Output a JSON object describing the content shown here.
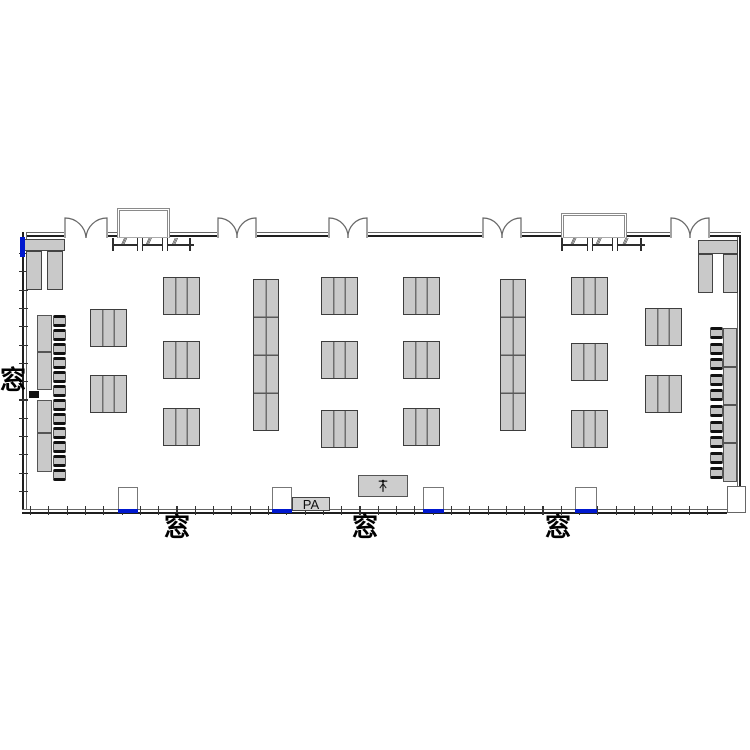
{
  "labels": {
    "window_left": "窓",
    "window_bottom_1": "窓",
    "window_bottom_2": "窓",
    "window_bottom_3": "窓",
    "pa": "PA",
    "rack_hatch": "///"
  },
  "colors": {
    "wall": "#1f1f1f",
    "furniture_fill": "#c9c9c9",
    "furniture_border": "#3d3d3d",
    "window_marker_blue": "#0018cf",
    "background": "#ffffff"
  },
  "icons": {
    "stage_icon": "mic-stand-icon"
  },
  "floorplan": {
    "walls": [
      {
        "dir": "h",
        "x": 22,
        "y": 232,
        "w": 42,
        "h": 5
      },
      {
        "dir": "h",
        "x": 108,
        "y": 232,
        "w": 109,
        "h": 5
      },
      {
        "dir": "h",
        "x": 257,
        "y": 232,
        "w": 71,
        "h": 5
      },
      {
        "dir": "h",
        "x": 368,
        "y": 232,
        "w": 114,
        "h": 5
      },
      {
        "dir": "h",
        "x": 522,
        "y": 232,
        "w": 148,
        "h": 5
      },
      {
        "dir": "h",
        "x": 710,
        "y": 232,
        "w": 31,
        "h": 5
      },
      {
        "dir": "v",
        "x": 22,
        "y": 232,
        "w": 5,
        "h": 281
      },
      {
        "dir": "v",
        "side": "right",
        "x": 737,
        "y": 237,
        "w": 4,
        "h": 249
      },
      {
        "dir": "h",
        "x": 22,
        "y": 509,
        "w": 705,
        "h": 5
      }
    ],
    "ticks": {
      "left": {
        "x": 19,
        "w": 9,
        "h": 1.2,
        "y0": 253,
        "y1": 506,
        "step": 18.3
      },
      "bottom": {
        "y": 506,
        "w": 1.2,
        "h": 9,
        "x0": 30,
        "x1": 723,
        "step": 18.3
      }
    },
    "doors": [
      {
        "x": 64,
        "y": 216,
        "w": 44,
        "h": 22
      },
      {
        "x": 217,
        "y": 216,
        "w": 40,
        "h": 22
      },
      {
        "x": 328,
        "y": 216,
        "w": 40,
        "h": 22
      },
      {
        "x": 482,
        "y": 216,
        "w": 40,
        "h": 22
      },
      {
        "x": 670,
        "y": 216,
        "w": 40,
        "h": 22
      }
    ],
    "alcoves": [
      {
        "x": 117,
        "y": 208,
        "w": 53,
        "h": 30
      },
      {
        "x": 561,
        "y": 213,
        "w": 66,
        "h": 25
      }
    ],
    "coat_racks": [
      {
        "x": 112,
        "y": 238,
        "w": 82,
        "h": 14
      },
      {
        "x": 561,
        "y": 238,
        "w": 84,
        "h": 14
      }
    ],
    "benches": [
      {
        "x": 24,
        "y": 239,
        "w": 41,
        "h": 12
      },
      {
        "x": 26,
        "y": 251,
        "w": 16,
        "h": 39
      },
      {
        "x": 47,
        "y": 251,
        "w": 16,
        "h": 39
      },
      {
        "x": 698,
        "y": 240,
        "w": 40,
        "h": 14
      },
      {
        "x": 698,
        "y": 254,
        "w": 15,
        "h": 39
      },
      {
        "x": 723,
        "y": 254,
        "w": 15,
        "h": 39
      }
    ],
    "tables_standard": [
      [
        90,
        309
      ],
      [
        90,
        375
      ],
      [
        163,
        277
      ],
      [
        163,
        341
      ],
      [
        163,
        408
      ],
      [
        321,
        277
      ],
      [
        321,
        341
      ],
      [
        321,
        410
      ],
      [
        403,
        277
      ],
      [
        403,
        341
      ],
      [
        403,
        408
      ],
      [
        571,
        277
      ],
      [
        571,
        343
      ],
      [
        571,
        410
      ],
      [
        645,
        308
      ],
      [
        645,
        375
      ]
    ],
    "table_standard_size": {
      "w": 37,
      "h": 38
    },
    "tables_long": [
      [
        253,
        279
      ],
      [
        500,
        279
      ]
    ],
    "table_long_size": {
      "w": 26,
      "h": 152
    },
    "counters": {
      "left": {
        "x": 37,
        "w": 15,
        "segments": [
          {
            "y": 315,
            "h": 37
          },
          {
            "y": 352,
            "h": 38
          },
          {
            "y": 400,
            "h": 33
          },
          {
            "y": 433,
            "h": 39
          }
        ]
      },
      "right": {
        "x": 723,
        "w": 14,
        "segments": [
          {
            "y": 328,
            "h": 39
          },
          {
            "y": 367,
            "h": 38
          },
          {
            "y": 405,
            "h": 38
          },
          {
            "y": 443,
            "h": 39
          }
        ]
      }
    },
    "black_marks": [
      {
        "x": 29,
        "y": 391,
        "w": 10,
        "h": 7
      }
    ],
    "chairs": {
      "left": {
        "x": 53,
        "w": 13,
        "h": 12,
        "y_start": 315,
        "step": 14,
        "count": 12
      },
      "right": {
        "x": 710,
        "w": 13,
        "h": 12,
        "y_start": 327,
        "step": 15.6,
        "count": 10
      }
    },
    "pillars": [
      {
        "x": 118,
        "w": 20
      },
      {
        "x": 272,
        "w": 20
      },
      {
        "x": 423,
        "w": 21
      },
      {
        "x": 575,
        "w": 22
      }
    ],
    "pillar_y": 487,
    "pillar_h": 23,
    "blue_markers": [
      {
        "x": 20,
        "y": 237,
        "w": 5,
        "h": 20
      }
    ],
    "corner_boxes": [
      {
        "x": 727,
        "y": 486,
        "w": 19,
        "h": 27
      }
    ],
    "stage": {
      "x": 358,
      "y": 475,
      "w": 50,
      "h": 22
    },
    "pa_box": {
      "x": 292,
      "y": 497,
      "w": 38,
      "h": 14
    },
    "window_label_positions": {
      "left": {
        "x": 0,
        "y": 368
      },
      "bottom": [
        {
          "x": 164,
          "y": 515
        },
        {
          "x": 352,
          "y": 515
        },
        {
          "x": 545,
          "y": 515
        }
      ]
    }
  }
}
